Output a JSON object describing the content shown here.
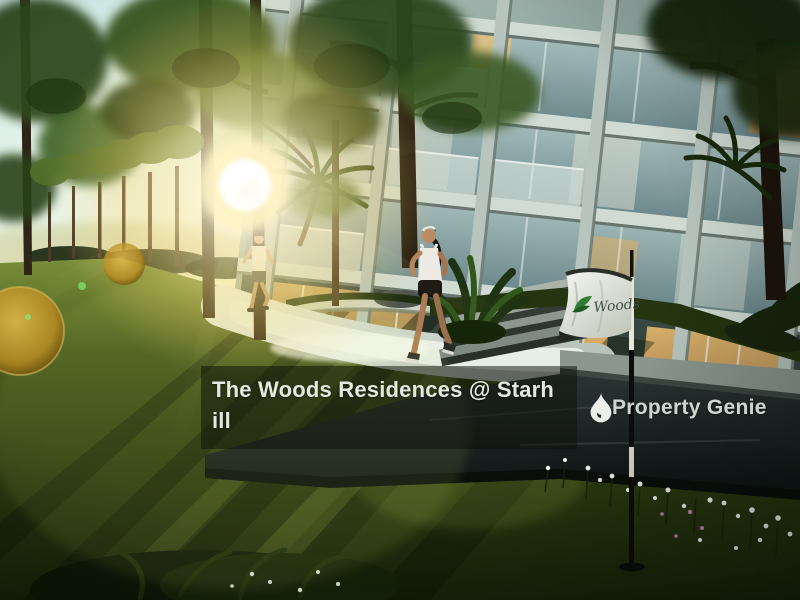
{
  "scene": {
    "description": "3D rendering of a condominium at golden hour: joggers on a curved garden path, lawn with long tree shadows, flower bed, and a course flag in front of the building",
    "flag_label": "Woods"
  },
  "caption": {
    "full_title": "The Woods Residences @ Starhill",
    "line1": "The Woods Residences @ Starh",
    "line2": "ill",
    "overlay_bg": "rgba(15,18,10,0.52)",
    "text_color": "#e4e8df"
  },
  "watermark": {
    "brand": "Property Genie",
    "icon": "flame-genie-icon",
    "text_color": "#dce1db"
  },
  "colors": {
    "sun_glow": "#ffd66e",
    "grass_dark": "#2a3a10",
    "building_facade": "#8aa09b",
    "flag_leaf": "#2e7d32",
    "bokeh_gold": "#c79a2e"
  }
}
